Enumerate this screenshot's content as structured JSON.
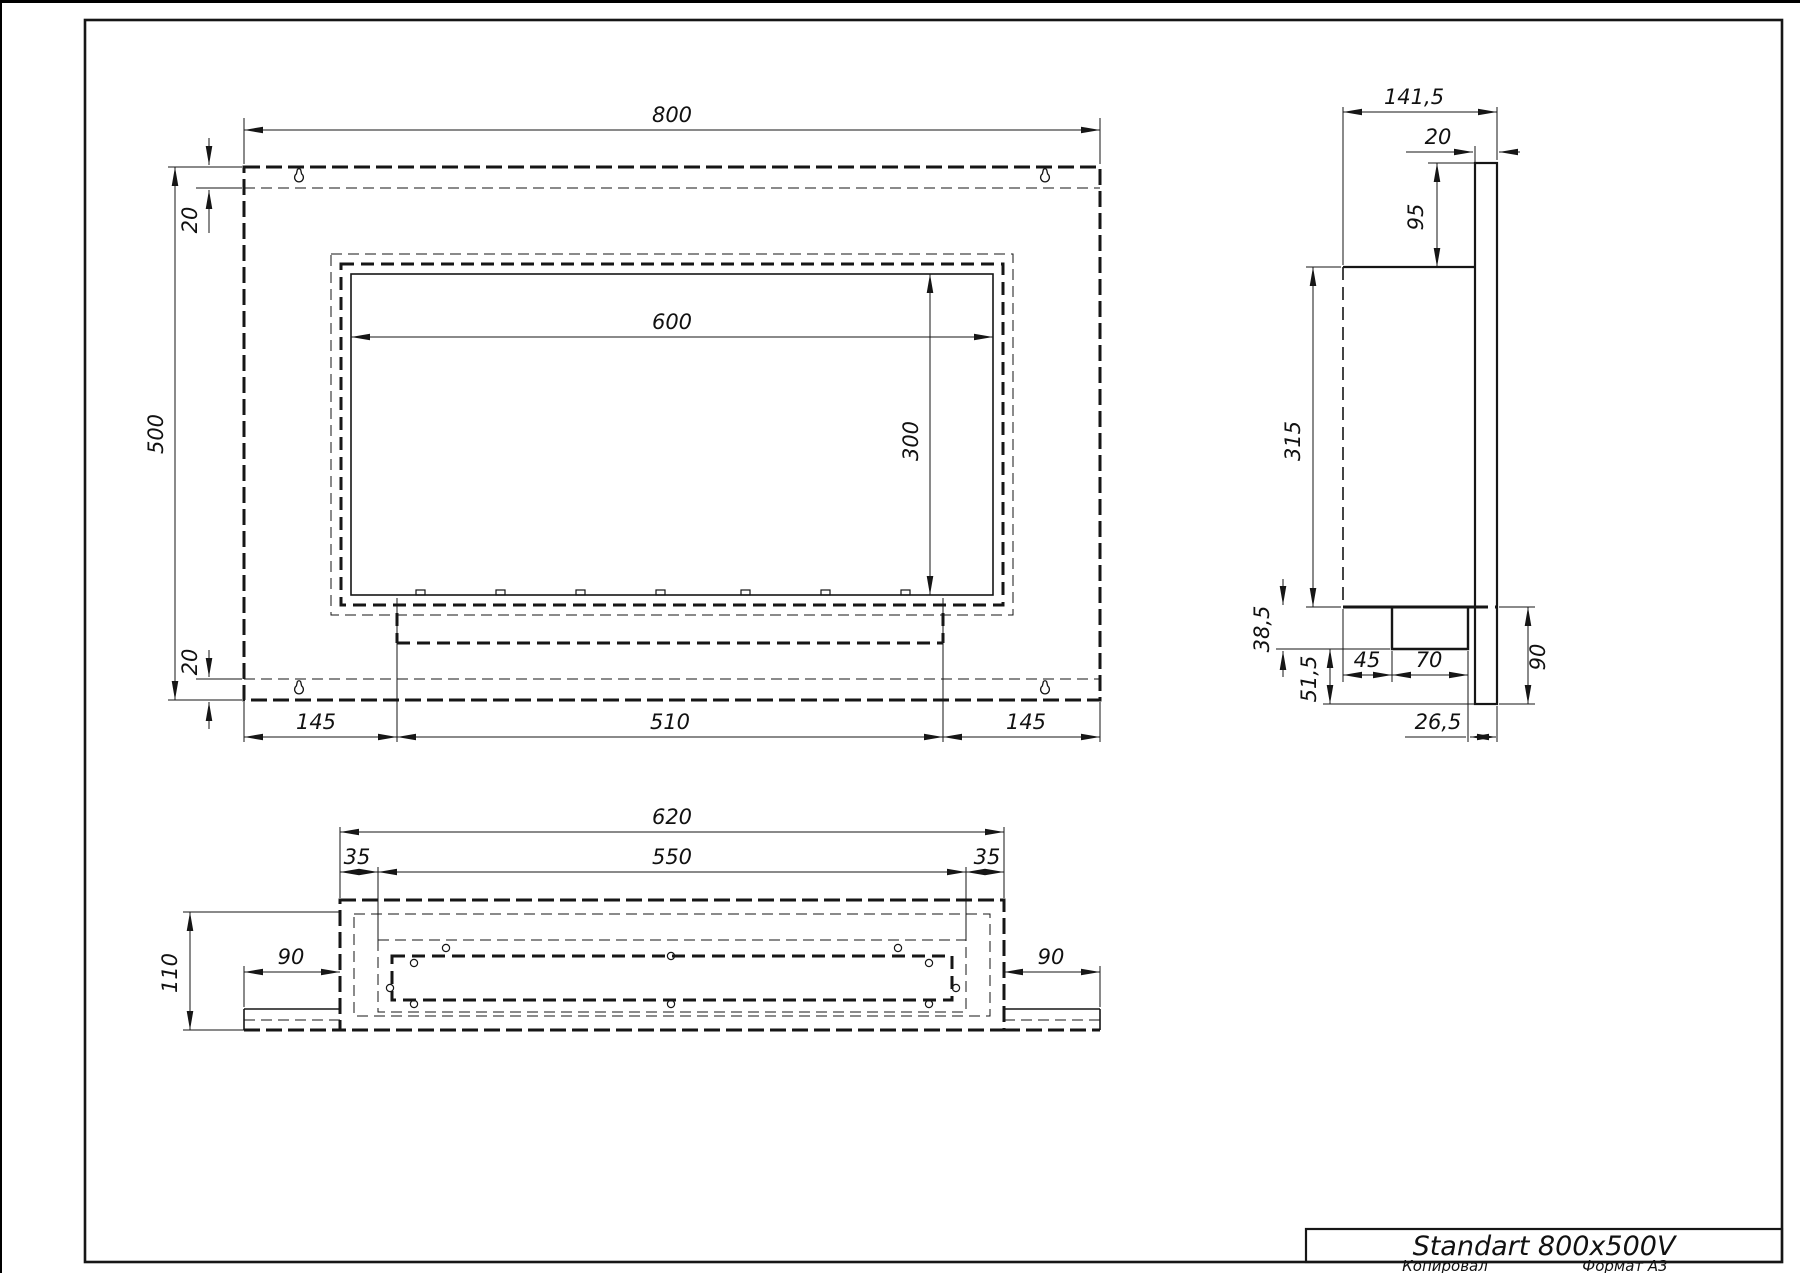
{
  "sheet": {
    "background": "#ffffff",
    "line_color": "#161616",
    "format_note": "A3 landscape drawing sheet"
  },
  "title_block": {
    "product": "Standart 800x500V",
    "copied_label": "Копировал",
    "format_label": "Формат А3"
  },
  "views": {
    "front": {
      "label": "front view",
      "dims": {
        "width": "800",
        "height": "500",
        "top_inset": "20",
        "bottom_inset": "20",
        "opening_width": "600",
        "opening_height": "300",
        "margin_left": "145",
        "burner_width": "510",
        "margin_right": "145"
      }
    },
    "side": {
      "label": "side view",
      "dims": {
        "depth": "141,5",
        "plate_thickness": "20",
        "top_gap": "95",
        "body_height": "315",
        "burner_depth": "38,5",
        "bottom_gap": "51,5",
        "burner_offset": "45",
        "burner_width": "70",
        "rear_offset": "26,5",
        "plate_extension": "90"
      }
    },
    "bottom": {
      "label": "bottom view",
      "dims": {
        "body_width": "620",
        "inset_left": "35",
        "opening_width": "550",
        "inset_right": "35",
        "depth": "110",
        "flange_left": "90",
        "flange_right": "90"
      }
    }
  }
}
